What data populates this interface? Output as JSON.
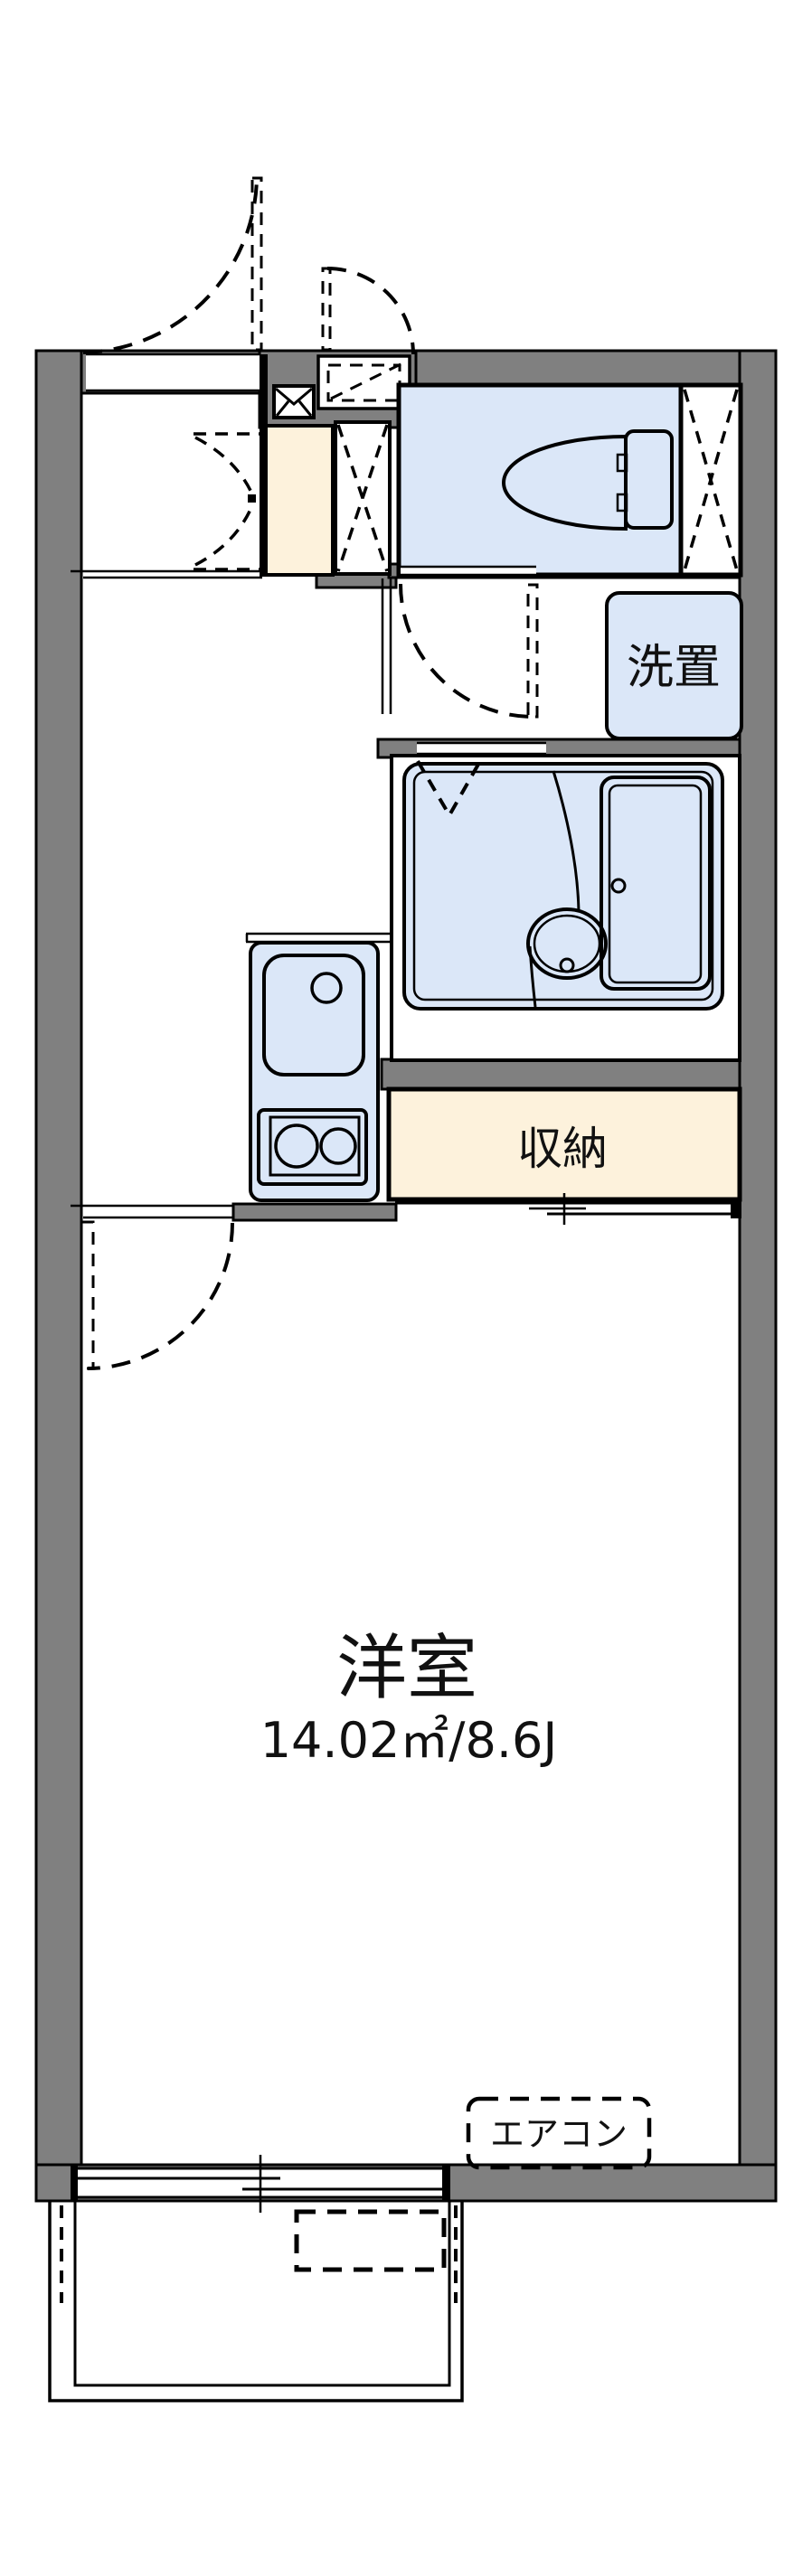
{
  "floor_plan": {
    "type": "japanese-apartment-1K",
    "labels": {
      "washer_space": "洗置",
      "storage": "収納",
      "main_room": "洋室",
      "main_room_size": "14.02㎡/8.6J",
      "aircon": "エアコン"
    },
    "main_room": {
      "name": "洋室",
      "area_sqm": "14.02",
      "area_jo": "8.6"
    },
    "features": [
      "entrance-door-swing",
      "meter-box",
      "mailbox",
      "shoe-area",
      "pipe-shaft",
      "toilet",
      "washer-space",
      "unit-bath",
      "bathtub",
      "washbasin",
      "kitchen-sink",
      "two-burner-stove",
      "storage-closet",
      "sliding-window",
      "balcony",
      "air-conditioner-space"
    ],
    "colors": {
      "wall": "#808080",
      "room_blue": "#dbe7f8",
      "storage_cream": "#fdf2dc",
      "line": "#000000",
      "background": "#ffffff"
    }
  }
}
